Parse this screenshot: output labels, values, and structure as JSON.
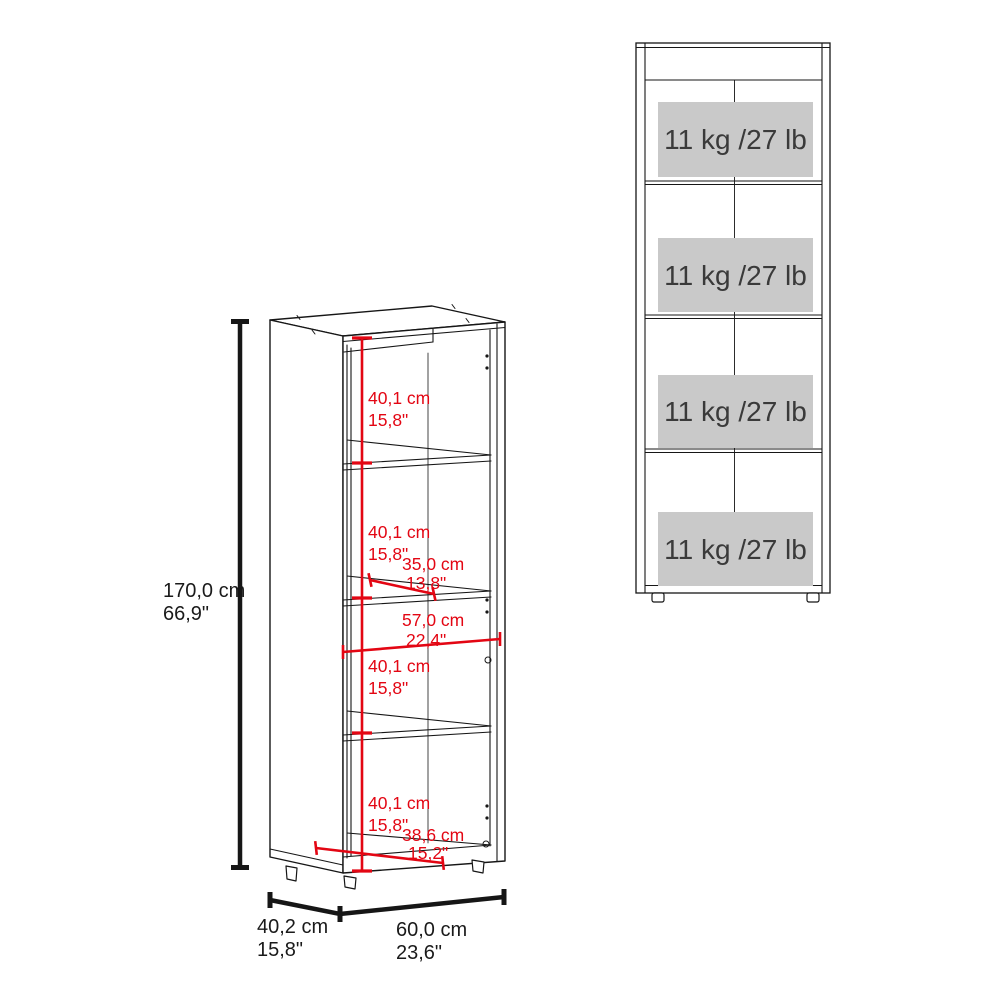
{
  "colors": {
    "dimension_red": "#e30613",
    "line_black": "#161616",
    "shelf_label_bg": "#c9c9c9",
    "shelf_label_text": "#3a3a3a"
  },
  "side_view": {
    "height": {
      "cm": "170,0 cm",
      "inches": "66,9\""
    },
    "compartments": [
      {
        "cm": "40,1 cm",
        "inches": "15,8\""
      },
      {
        "cm": "40,1 cm",
        "inches": "15,8\""
      },
      {
        "cm": "40,1 cm",
        "inches": "15,8\""
      },
      {
        "cm": "40,1 cm",
        "inches": "15,8\""
      }
    ],
    "shelf_depth": {
      "cm": "35,0 cm",
      "inches": "13,8\""
    },
    "interior_width": {
      "cm": "57,0 cm",
      "inches": "22,4\""
    },
    "base_depth": {
      "cm": "38,6 cm",
      "inches": "15,2\""
    },
    "depth": {
      "cm": "40,2 cm",
      "inches": "15,8\""
    },
    "width": {
      "cm": "60,0 cm",
      "inches": "23,6\""
    }
  },
  "front_view": {
    "shelves": [
      {
        "capacity": "11 kg /27 lb"
      },
      {
        "capacity": "11 kg /27 lb"
      },
      {
        "capacity": "11 kg /27 lb"
      },
      {
        "capacity": "11 kg /27 lb"
      }
    ]
  }
}
